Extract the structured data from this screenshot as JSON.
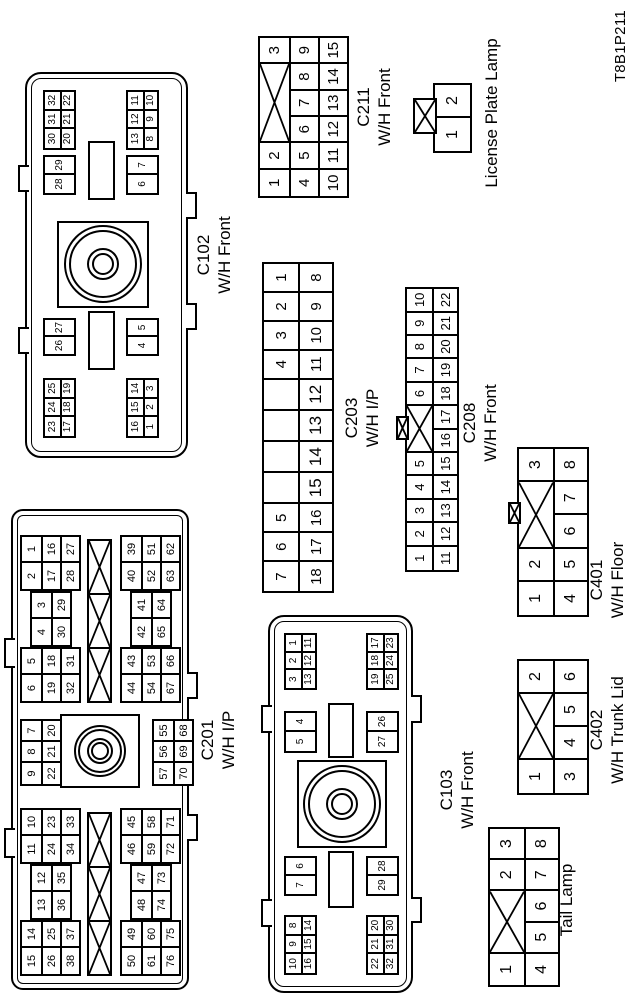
{
  "figure_code": "T8B1P211",
  "colors": {
    "line": "#000000",
    "background": "#ffffff"
  },
  "connectors": [
    {
      "id": "c201",
      "type": "bolt-large",
      "label": [
        "C201",
        "W/H I/P"
      ],
      "blocks": {
        "tl": [
          [
            [
              "15",
              "14"
            ],
            [
              "26",
              "25"
            ],
            [
              "38",
              "37"
            ]
          ],
          [
            [
              "13",
              "12"
            ],
            [
              "36",
              "35"
            ]
          ],
          [
            [
              "11",
              "10"
            ],
            [
              "24",
              "23"
            ],
            [
              "34",
              "33"
            ]
          ]
        ],
        "mt": [
          [
            "9",
            "8",
            "7"
          ],
          [
            "22",
            "21",
            "20"
          ]
        ],
        "tr": [
          [
            [
              "6",
              "5"
            ],
            [
              "19",
              "18"
            ],
            [
              "32",
              "31"
            ]
          ],
          [
            [
              "4",
              "3"
            ],
            [
              "30",
              "29"
            ]
          ],
          [
            [
              "2",
              "1"
            ],
            [
              "17",
              "16"
            ],
            [
              "28",
              "27"
            ]
          ]
        ],
        "bl": [
          [
            [
              "50",
              "49"
            ],
            [
              "61",
              "60"
            ],
            [
              "76",
              "75"
            ]
          ],
          [
            [
              "48",
              "47"
            ],
            [
              "74",
              "73"
            ]
          ],
          [
            [
              "46",
              "45"
            ],
            [
              "59",
              "58"
            ],
            [
              "72",
              "71"
            ]
          ]
        ],
        "mb": [
          [
            "57",
            "56",
            "55"
          ],
          [
            "70",
            "69",
            "68"
          ]
        ],
        "br": [
          [
            [
              "44",
              "43"
            ],
            [
              "54",
              "53"
            ],
            [
              "67",
              "66"
            ]
          ],
          [
            [
              "42",
              "41"
            ],
            [
              "65",
              "64"
            ]
          ],
          [
            [
              "40",
              "39"
            ],
            [
              "52",
              "51"
            ],
            [
              "63",
              "62"
            ]
          ]
        ]
      }
    },
    {
      "id": "c102",
      "type": "bolt",
      "label": [
        "C102",
        "W/H Front"
      ],
      "blocks": {
        "lt": [
          [
            "23",
            "24",
            "25"
          ],
          [
            "17",
            "18",
            "19"
          ]
        ],
        "lb": [
          [
            "16",
            "15",
            "14"
          ],
          [
            "1",
            "2",
            "3"
          ]
        ],
        "mlt": [
          [
            "26",
            "27"
          ]
        ],
        "mlb": [
          [
            "4",
            "5"
          ]
        ],
        "mrt": [
          [
            "28",
            "29"
          ]
        ],
        "mrb": [
          [
            "6",
            "7"
          ]
        ],
        "rt": [
          [
            "30",
            "31",
            "32"
          ],
          [
            "20",
            "21",
            "22"
          ]
        ],
        "rb": [
          [
            "13",
            "12",
            "11"
          ],
          [
            "8",
            "9",
            "10"
          ]
        ]
      }
    },
    {
      "id": "c103",
      "type": "bolt",
      "label": [
        "C103",
        "W/H Front"
      ],
      "blocks": {
        "lt": [
          [
            "10",
            "9",
            "8"
          ],
          [
            "16",
            "15",
            "14"
          ]
        ],
        "lb": [
          [
            "22",
            "21",
            "20"
          ],
          [
            "32",
            "31",
            "30"
          ]
        ],
        "mlt": [
          [
            "7",
            "6"
          ]
        ],
        "mlb": [
          [
            "29",
            "28"
          ]
        ],
        "mrt": [
          [
            "5",
            "4"
          ]
        ],
        "mrb": [
          [
            "27",
            "26"
          ]
        ],
        "rt": [
          [
            "3",
            "2",
            "1"
          ],
          [
            "13",
            "12",
            "11"
          ]
        ],
        "rb": [
          [
            "19",
            "18",
            "17"
          ],
          [
            "25",
            "24",
            "23"
          ]
        ]
      }
    },
    {
      "id": "c203",
      "type": "grid",
      "label": [
        "C203",
        "W/H I/P"
      ],
      "rows": [
        [
          "7",
          "6",
          "5",
          {
            "v": "",
            "w": 1.08
          },
          {
            "v": "",
            "w": 1.08
          },
          {
            "v": "",
            "w": 1.08
          },
          {
            "v": "",
            "w": 1.08
          },
          "4",
          "3",
          "2",
          "1"
        ],
        [
          "18",
          "17",
          "16",
          {
            "v": "15",
            "w": 1.08
          },
          {
            "v": "14",
            "w": 1.08
          },
          {
            "v": "13",
            "w": 1.08
          },
          {
            "v": "12",
            "w": 1.08
          },
          "11",
          "10",
          "9",
          "8"
        ]
      ]
    },
    {
      "id": "c208",
      "type": "grid",
      "label": [
        "C208",
        "W/H Front"
      ],
      "rows": [
        [
          "1",
          "2",
          "3",
          "4",
          "5",
          {
            "x": true,
            "w": 2
          },
          "6",
          "7",
          "8",
          "9",
          "10"
        ],
        [
          "11",
          "12",
          "13",
          "14",
          "15",
          "16",
          "17",
          "18",
          "19",
          "20",
          "21",
          "22"
        ]
      ]
    },
    {
      "id": "c211",
      "type": "grid",
      "label": [
        "C211",
        "W/H Front"
      ],
      "rows": [
        [
          "1",
          "2",
          {
            "x": true,
            "w": 3
          },
          "3"
        ],
        [
          "4",
          "5",
          "6",
          "7",
          "8",
          "9"
        ],
        [
          "10",
          "11",
          "12",
          "13",
          "14",
          "15"
        ]
      ]
    },
    {
      "id": "license",
      "type": "grid",
      "label": [
        "License Plate Lamp"
      ],
      "rows": [
        [
          "1",
          "2"
        ]
      ]
    },
    {
      "id": "c401",
      "type": "grid",
      "label": [
        "C401",
        "W/H Floor"
      ],
      "rows": [
        [
          "1",
          "2",
          {
            "x": true,
            "w": 2
          },
          "3"
        ],
        [
          "4",
          "5",
          "6",
          "7",
          "8"
        ]
      ]
    },
    {
      "id": "c402",
      "type": "grid",
      "label": [
        "C402",
        "W/H Trunk Lid"
      ],
      "rows": [
        [
          "1",
          {
            "x": true,
            "w": 2
          },
          "2"
        ],
        [
          "3",
          "4",
          "5",
          "6"
        ]
      ]
    },
    {
      "id": "tail",
      "type": "grid",
      "label": [
        "Tail Lamp"
      ],
      "rows": [
        [
          "1",
          {
            "x": true,
            "w": 2
          },
          "2",
          "3"
        ],
        [
          "4",
          "5",
          "6",
          "7",
          "8"
        ]
      ]
    }
  ]
}
